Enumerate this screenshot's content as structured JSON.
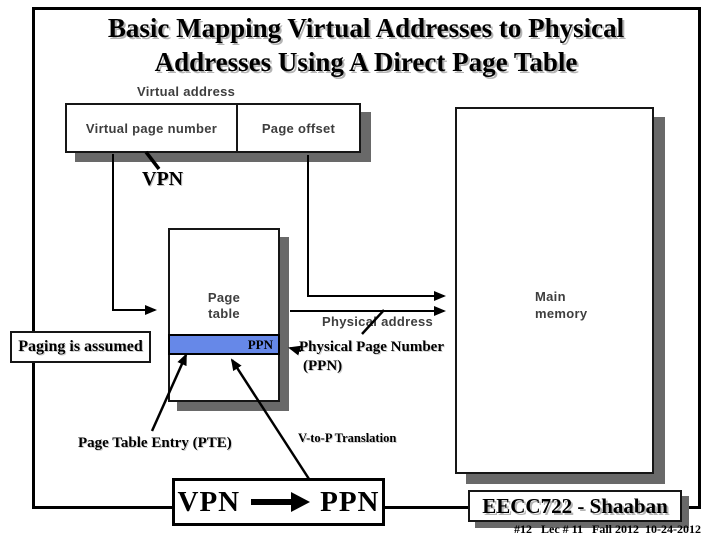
{
  "slide": {
    "title_line1": "Basic Mapping Virtual Addresses to Physical",
    "title_line2": "Addresses Using A Direct Page Table"
  },
  "figure": {
    "virtual_address_label": "Virtual address",
    "virtual_page_number_cell": "Virtual page number",
    "page_offset_cell": "Page offset",
    "vpn_label": "VPN",
    "page_table_line1": "Page",
    "page_table_line2": "table",
    "ppn_entry": "PPN",
    "physical_address_label": "Physical address",
    "main_memory_line1": "Main",
    "main_memory_line2": "memory"
  },
  "annotations": {
    "paging_assumed": "Paging is assumed",
    "physical_page_number_line1": "Physical Page Number",
    "physical_page_number_line2": "(PPN)",
    "pte_label": "Page Table Entry (PTE)",
    "v_to_p_label": "V-to-P Translation",
    "translation_from": "VPN",
    "translation_to": "PPN"
  },
  "footer": {
    "course": "EECC722 - Shaaban",
    "lecture_info": "#12   Lec # 11   Fall 2012  10-24-2012"
  },
  "colors": {
    "ppn_highlight": "#6688E8",
    "box_shadow_gray": "#696969",
    "figure_text_gray": "#3e3e3e"
  }
}
